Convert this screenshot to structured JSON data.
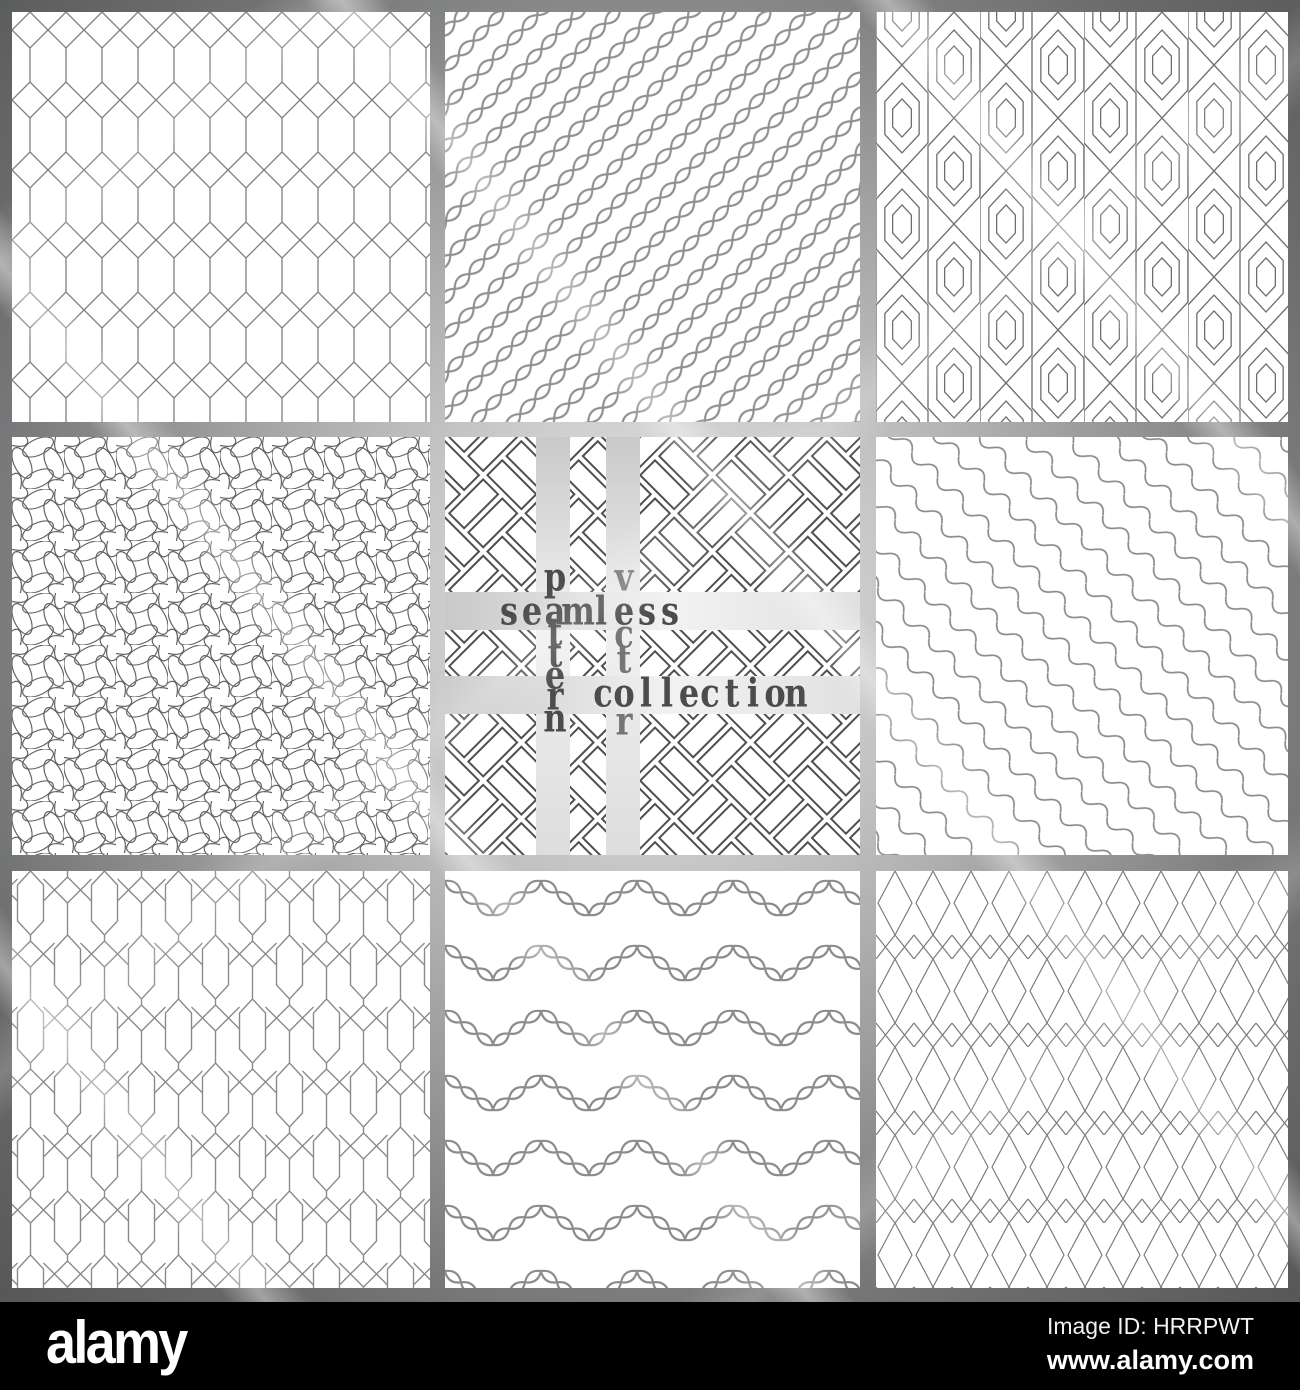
{
  "crossword": {
    "words": [
      {
        "id": "seamless",
        "text": "seamless",
        "direction": "horizontal"
      },
      {
        "id": "pattern",
        "text": "pattern",
        "direction": "vertical"
      },
      {
        "id": "vector",
        "text": "vector",
        "direction": "vertical"
      },
      {
        "id": "collection",
        "text": "collection",
        "direction": "horizontal"
      }
    ],
    "primary_color": "#4c4c4c",
    "secondary_color": "#757575"
  },
  "tiles": [
    {
      "id": "tile-1",
      "row": 1,
      "col": 1,
      "pattern": "diamond-lattice-trellis"
    },
    {
      "id": "tile-2",
      "row": 1,
      "col": 2,
      "pattern": "diagonal-twisted-rope"
    },
    {
      "id": "tile-3",
      "row": 1,
      "col": 3,
      "pattern": "nested-elongated-hexagons"
    },
    {
      "id": "tile-4",
      "row": 2,
      "col": 1,
      "pattern": "interlocking-petal-pinwheel"
    },
    {
      "id": "tile-5",
      "row": 2,
      "col": 2,
      "pattern": "diagonal-basketweave-bricks"
    },
    {
      "id": "tile-6",
      "row": 2,
      "col": 3,
      "pattern": "diagonal-wavy-lines"
    },
    {
      "id": "tile-7",
      "row": 3,
      "col": 1,
      "pattern": "hexagon-and-diamond-trellis"
    },
    {
      "id": "tile-8",
      "row": 3,
      "col": 2,
      "pattern": "chevron-twisted-rope-rows"
    },
    {
      "id": "tile-9",
      "row": 3,
      "col": 3,
      "pattern": "diamond-net-lattice"
    }
  ],
  "footer": {
    "logo_text": "alamy",
    "image_id": "Image ID: HRRPWT",
    "website": "www.alamy.com",
    "background": "#000000"
  }
}
